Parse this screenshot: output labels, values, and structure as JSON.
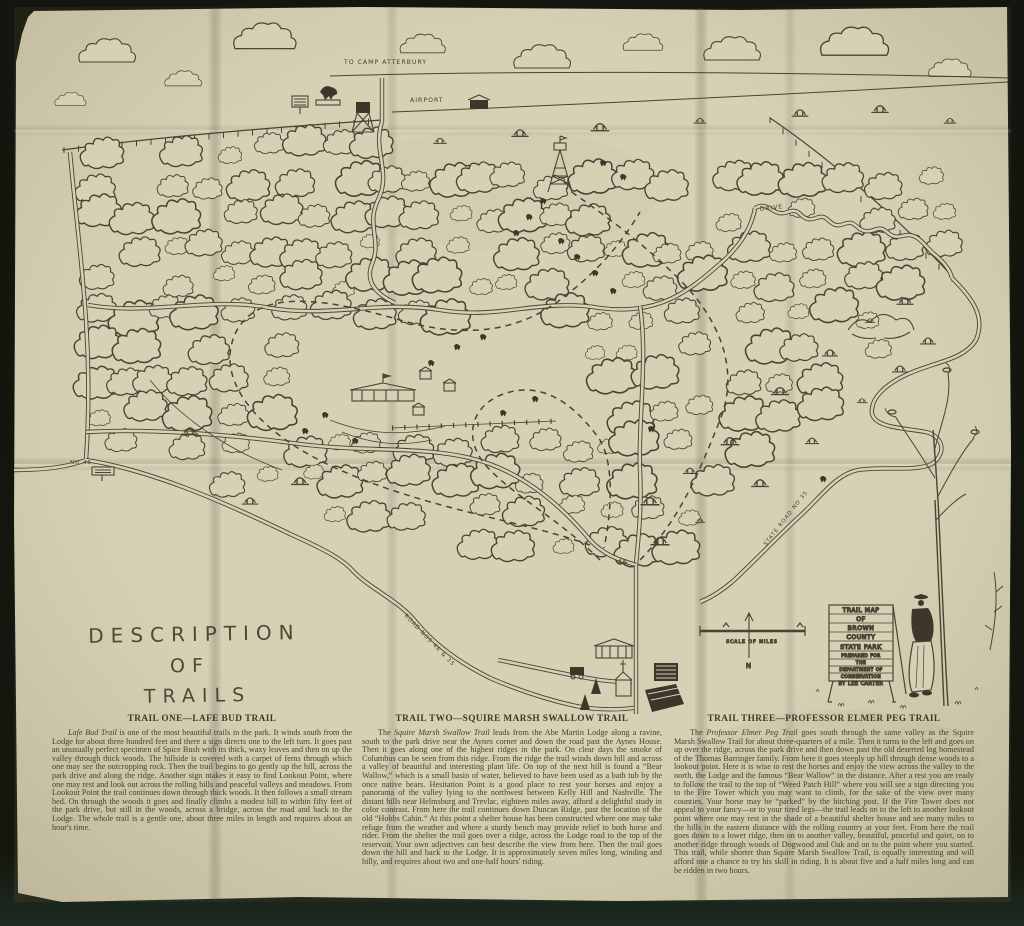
{
  "map": {
    "labels": {
      "to_camp": "TO CAMP ATTERBURY",
      "airport": "AIRPORT",
      "drive": "DRIVE",
      "no_46": "NO 46",
      "road_46_35": "ROAD NOS 46 & 35",
      "state_road_35": "STATE ROAD NO 35",
      "scale_of_miles": "SCALE OF MILES",
      "north": "N"
    },
    "sign": {
      "lines": [
        "TRAIL MAP",
        "OF",
        "BROWN",
        "COUNTY",
        "STATE PARK",
        "PREPARED FOR",
        "THE",
        "DEPARTMENT OF",
        "CONSERVATION",
        "BY LEE CARTER"
      ]
    },
    "title": {
      "lines": [
        "DESCRIPTION",
        "OF",
        "TRAILS"
      ]
    }
  },
  "trails": [
    {
      "heading": "TRAIL ONE—LAFE BUD TRAIL",
      "intro_prefix": "",
      "intro_italic": "Lafe Bud Trail",
      "body": " is one of the most beautiful trails in the park.  It winds south from the Lodge for about three hundred feet and there a sign directs one to the left turn.  It goes past an unusually perfect specimen of Spice Bush with its thick, waxy leaves and then on up the valley through thick woods.  The hillside is covered with a carpet of ferns through which one may see the outcropping rock.  Then the trail begins to go gently up the hill, across the park drive and along the ridge.  Another sign makes it easy to find Lookout Point, where one may rest and look out across the rolling hills and peaceful valleys and meadows.  From Lookout Point the trail continues down through thick woods.  It then follows a small stream bed.  On through the woods it goes and finally climbs a modest hill to within fifty feet of the park drive, but still in the woods, across a bridge, across the road and back to the Lodge.  The whole trail is a gentle one, about three miles in length and requires about an hour's time."
    },
    {
      "heading": "TRAIL TWO—SQUIRE MARSH SWALLOW TRAIL",
      "intro_prefix": "The ",
      "intro_italic": "Squire Marsh Swallow Trail",
      "body": " leads from the Abe Martin Lodge along a ravine, south to the park drive near the Aynes corner and down the road past the Aynes House.  Then it goes along one of the highest ridges in the park.  On clear days the smoke of Columbus can be seen from this ridge.  From the ridge the trail winds down hill and across a valley of beautiful and interesting plant life.  On top of the next hill is found a “Bear Wallow,” which is a small basin of water, believed to have been used as a bath tub by the once native bears.  Hesitation Point is a good place to rest your horses and enjoy a panorama of the valley lying to the northwest between Kelly Hill and Nashville.  The distant hills near Helmsburg and Trevlac, eighteen miles away, afford a delightful study in color contrast.  From here the trail continues down Duncan Ridge, past the location of the old “Hobbs Cabin.”  At this point a shelter house has been constructed where one may take refuge from the weather and where a sturdy bench may provide relief to both horse and rider.  From the shelter the trail goes over a ridge, across the Lodge road to the top of the reservoir.  Your own adjectives can best describe the view from here.  Then the trail goes down the hill and back to the Lodge.  It is approximately seven miles long, winding and hilly, and requires about two and one-half hours' riding."
    },
    {
      "heading": "TRAIL THREE—PROFESSOR ELMER PEG TRAIL",
      "intro_prefix": "The ",
      "intro_italic": "Professor Elmer Peg Trail",
      "body": " goes south through the same valley as the Squire Marsh Swallow Trail for about three-quarters of a mile.  Then it turns to the left and goes on up over the ridge, across the park drive and then down past the old deserted log homestead of the Thomas Barringer family.  From here it goes steeply up hill through dense woods to a lookout point.  Here it is wise to rest the horses and enjoy the view across the valley to the north, the Lodge and the famous “Bear Wallow” in the distance.  After a rest you are ready to follow the trail to the top of “Weed Patch Hill” where you will see a sign directing you to the Fire Tower which you may want to climb, for the sake of the view over many counties.  Your horse may be “parked” by the hitching post.  If the Fire Tower does not appeal to your fancy—or to your tired legs—the trail leads on to the left to another lookout point where one may rest in the shade of a beautiful shelter house and see many miles to the hills in the eastern distance with the rolling country at your feet.  From here the trail goes down to a lower ridge, then on to another valley, beautiful, peaceful and quiet, on to another ridge through woods of Dogwood and Oak and on to the point where you started.  This trail, while shorter than Squire Marsh Swallow Trail, is equally interesting and will afford one a chance to try his skill in riding.  It is about five and a half miles long and can be ridden in two hours."
    }
  ],
  "colors": {
    "paper": "#d6d0b5",
    "ink": "#4a4334",
    "background": "#13150e",
    "text": "#463f2f"
  }
}
